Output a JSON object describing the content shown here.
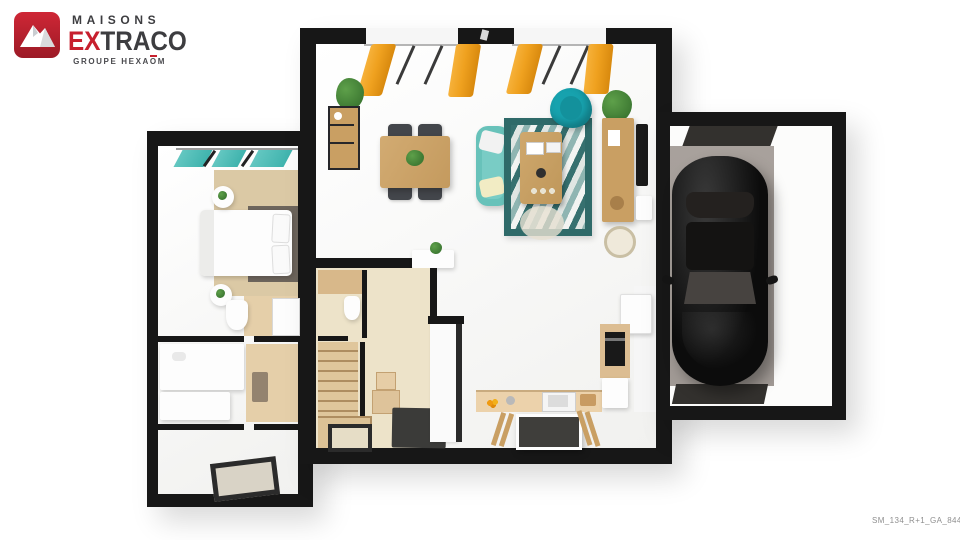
{
  "brand": {
    "maisons": "MAISONS",
    "extraco_red": "EX",
    "extraco_dark": "TRACO",
    "group_prefix": "GROUPE",
    "group_name_pre": "HEXA",
    "group_name_o": "O",
    "group_name_post": "M"
  },
  "floor_plan": {
    "reference_code": "SM_134_R+1_GA_84459"
  },
  "colors": {
    "brand_red": "#c7202e",
    "brand_dark": "#3d3d40",
    "wall_black": "#171717",
    "curtain_orange": "#efa11f",
    "curtain_teal": "#3fb3ad",
    "sofa_teal": "#68c2ba",
    "armchair_teal": "#17a2ae",
    "rug_teal": "#2f6a69",
    "wood": "#c99f63",
    "hall_beige": "#ede3c9",
    "tile_beige": "#e5cfa9",
    "carpet_beige": "#dbc9a5",
    "concrete_gray": "#a19a95",
    "car_black": "#0c0c0c",
    "mat_dark": "#3b3b39"
  }
}
